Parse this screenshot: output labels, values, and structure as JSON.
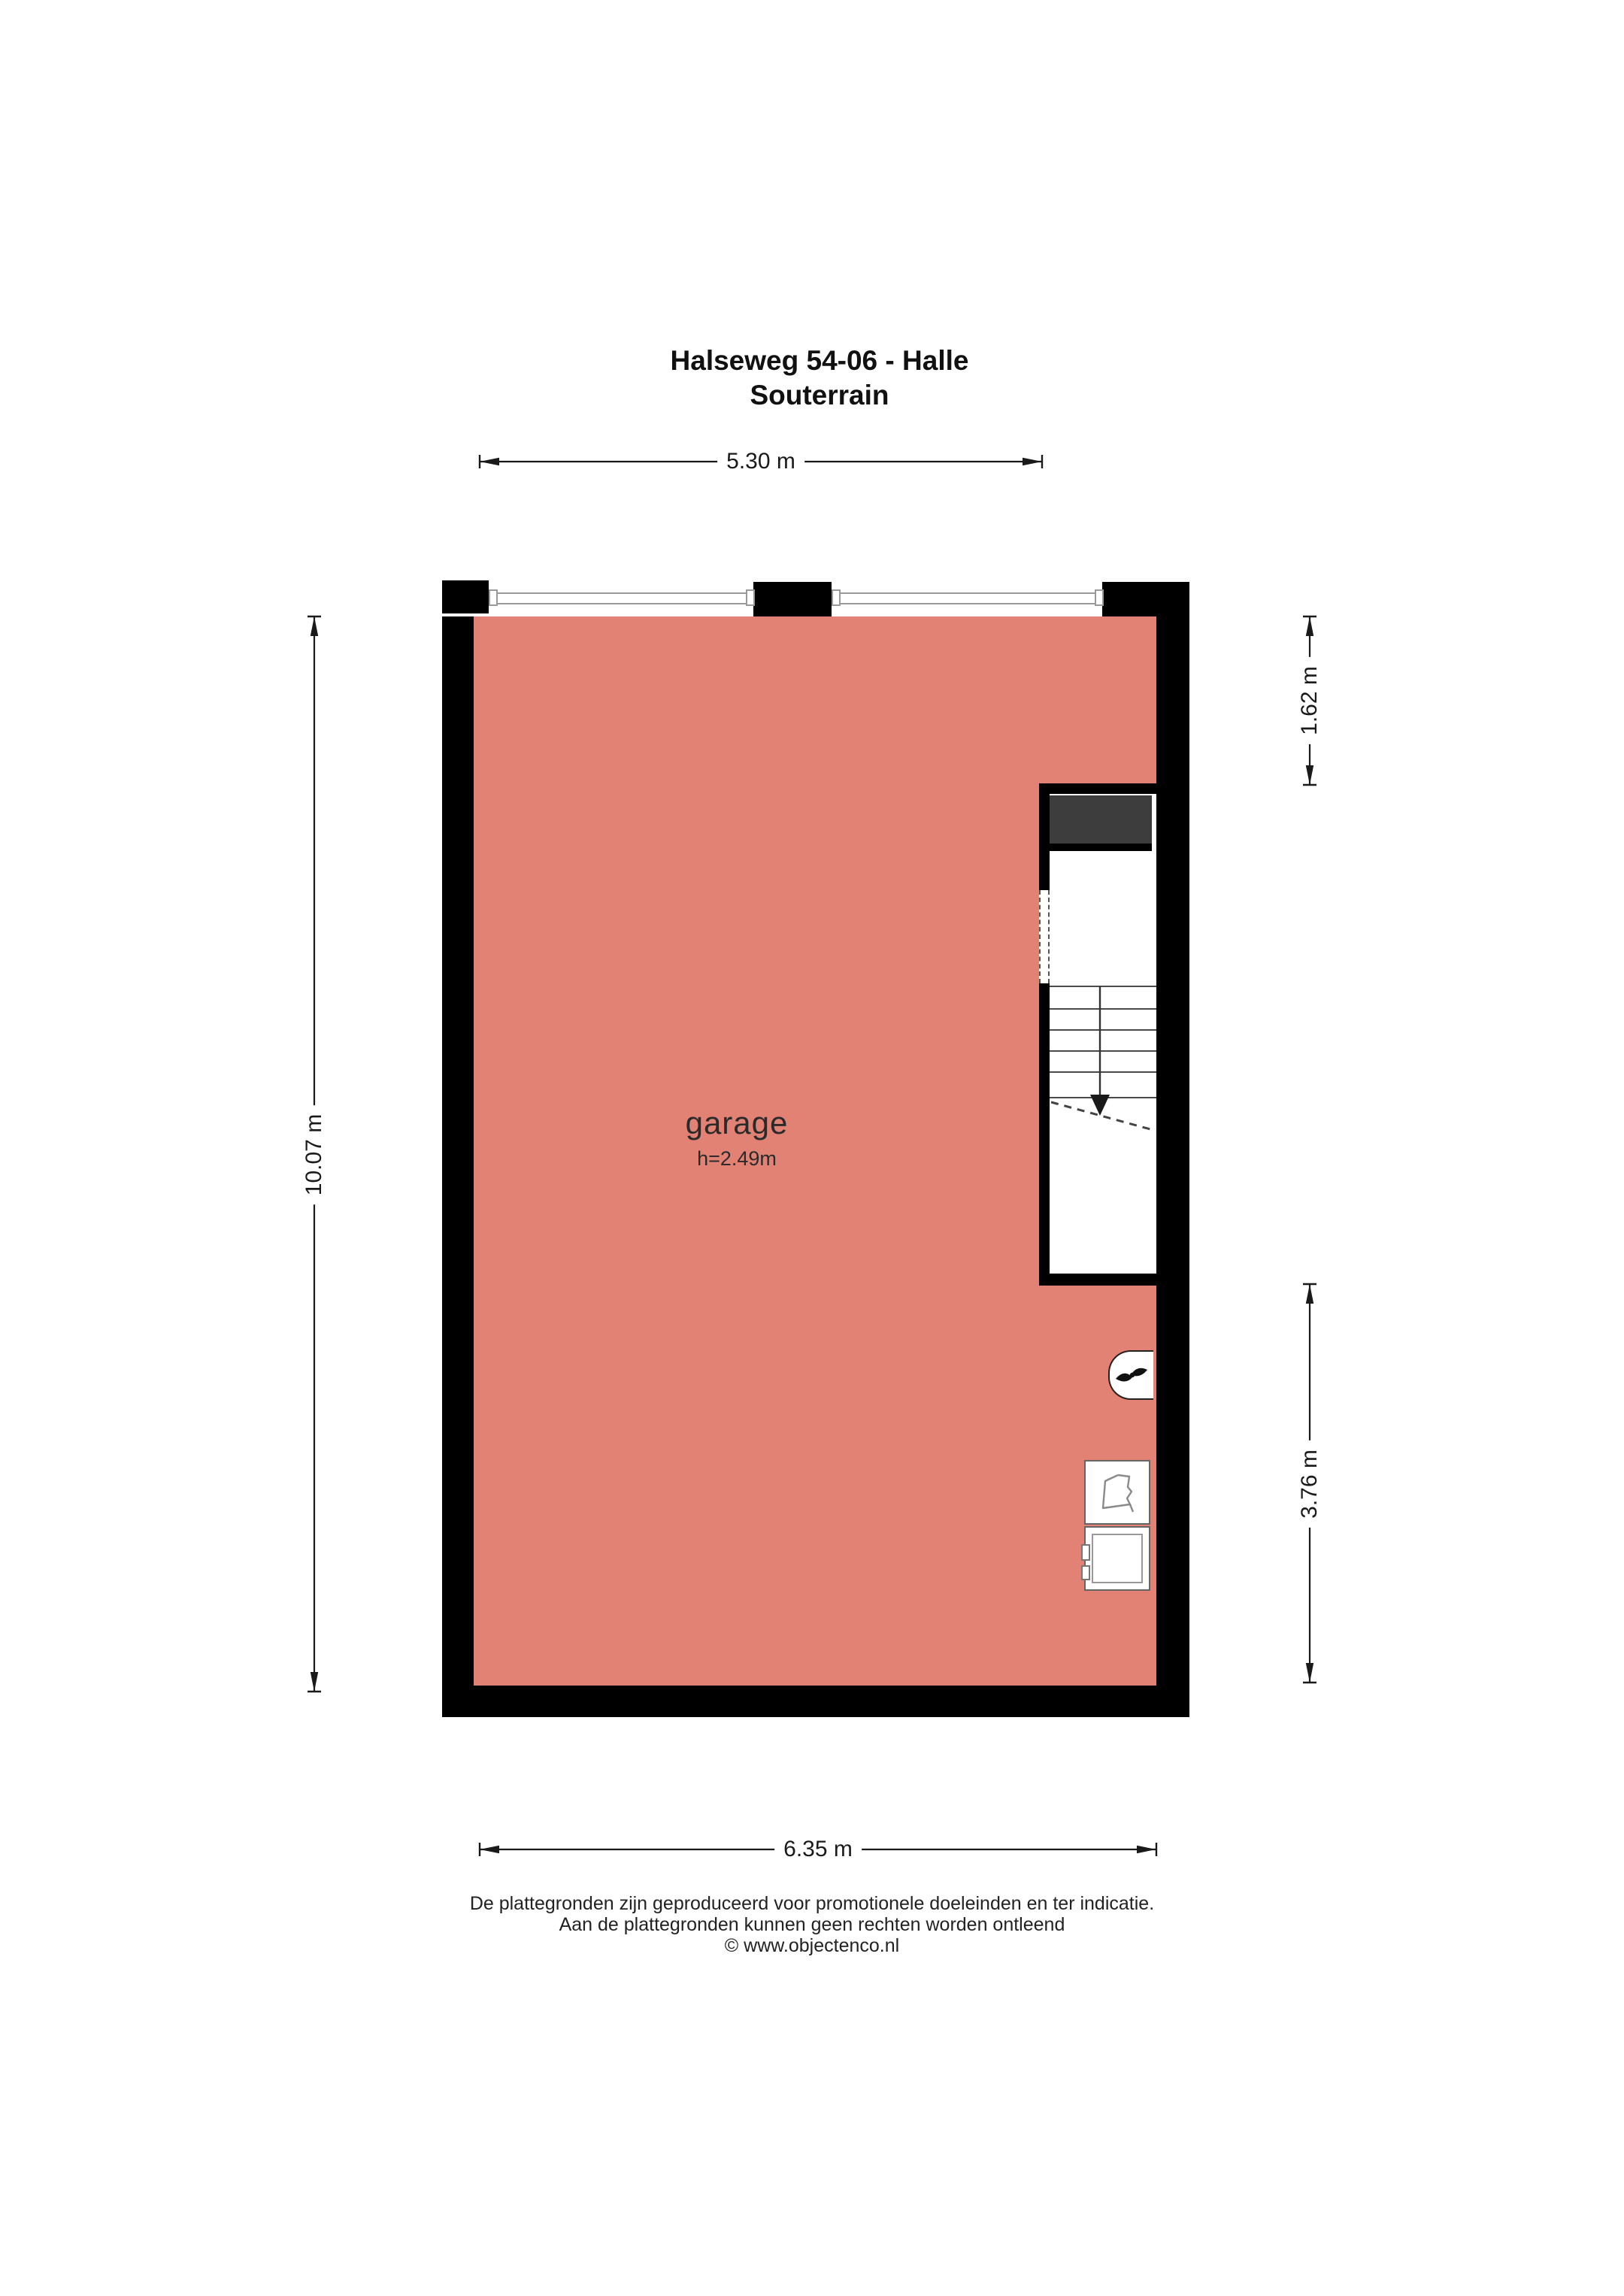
{
  "title": {
    "line1": "Halseweg 54-06 - Halle",
    "line2": "Souterrain"
  },
  "dimensions": {
    "top": "5.30 m",
    "bottom": "6.35 m",
    "left": "10.07 m",
    "right_upper": "1.62 m",
    "right_lower": "3.76 m"
  },
  "room": {
    "name": "garage",
    "ceiling_height": "h=2.49m"
  },
  "footer": {
    "line1": "De plattegronden zijn geproduceerd voor promotionele doeleinden en ter indicatie.",
    "line2": "Aan de plattegronden kunnen geen rechten worden ontleend",
    "line3": "© www.objectenco.nl"
  },
  "colors": {
    "floor": "#e18275",
    "wall": "#000000",
    "stair_block": "#3d3d3d",
    "dim": "#1a1a1a",
    "window_line": "#9a9a9a",
    "stair_line": "#4a4a4a"
  }
}
